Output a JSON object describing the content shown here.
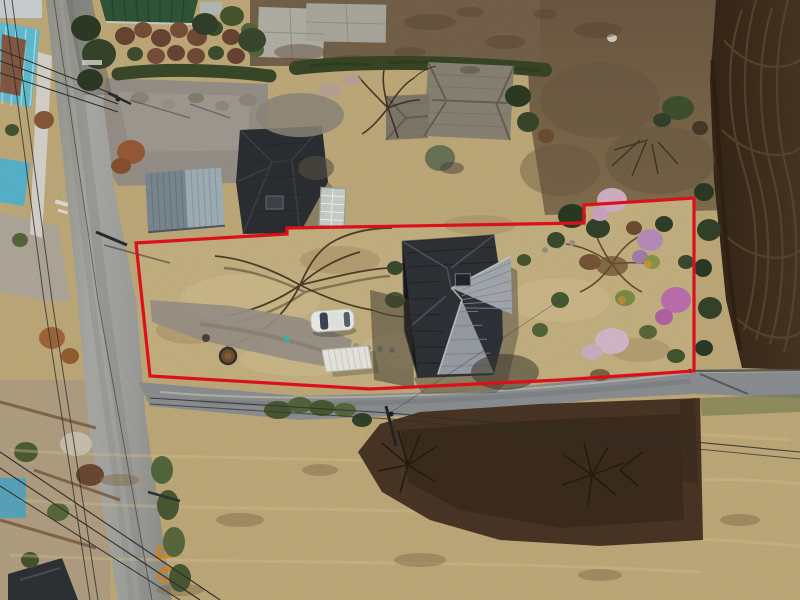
{
  "meta": {
    "title": "Aerial drone photo of residential land parcel with red survey boundary overlay",
    "width": 800,
    "height": 600
  },
  "overlay": {
    "boundary_color": "#e8101c",
    "boundary_stroke_width": "3.2",
    "boundary_points": "136,243 287,234 287,228 584,223 584,205 694,198 694,371 560,380 370,389 150,376"
  },
  "road_markings": {
    "speed_limit": "40",
    "paint_color": "#d28a2c"
  },
  "scene": {
    "car_color": "#f1f1ee",
    "shed_roof_color": "#edece6",
    "main_house_roof_dark": "#2f3237",
    "main_house_roof_light": "#a6acb1",
    "old_house_roof": "#8b8577",
    "warehouse_roof": "#8d9ba4",
    "green_roof": "#30573a",
    "teal_roof": "#5ec2d8",
    "plowed_field": "#3f2d1e",
    "dry_grass": "#c3ad7c",
    "parcel_lawn": "#c9b584",
    "north_dirt": "#77634b",
    "asphalt_left_road": "#a5a5a1",
    "asphalt_bottom_road": "#8e9294",
    "hedge_green": "#3a4a2a",
    "blossom_pink": "#d7b4cb",
    "blossom_magenta": "#c272b4"
  }
}
